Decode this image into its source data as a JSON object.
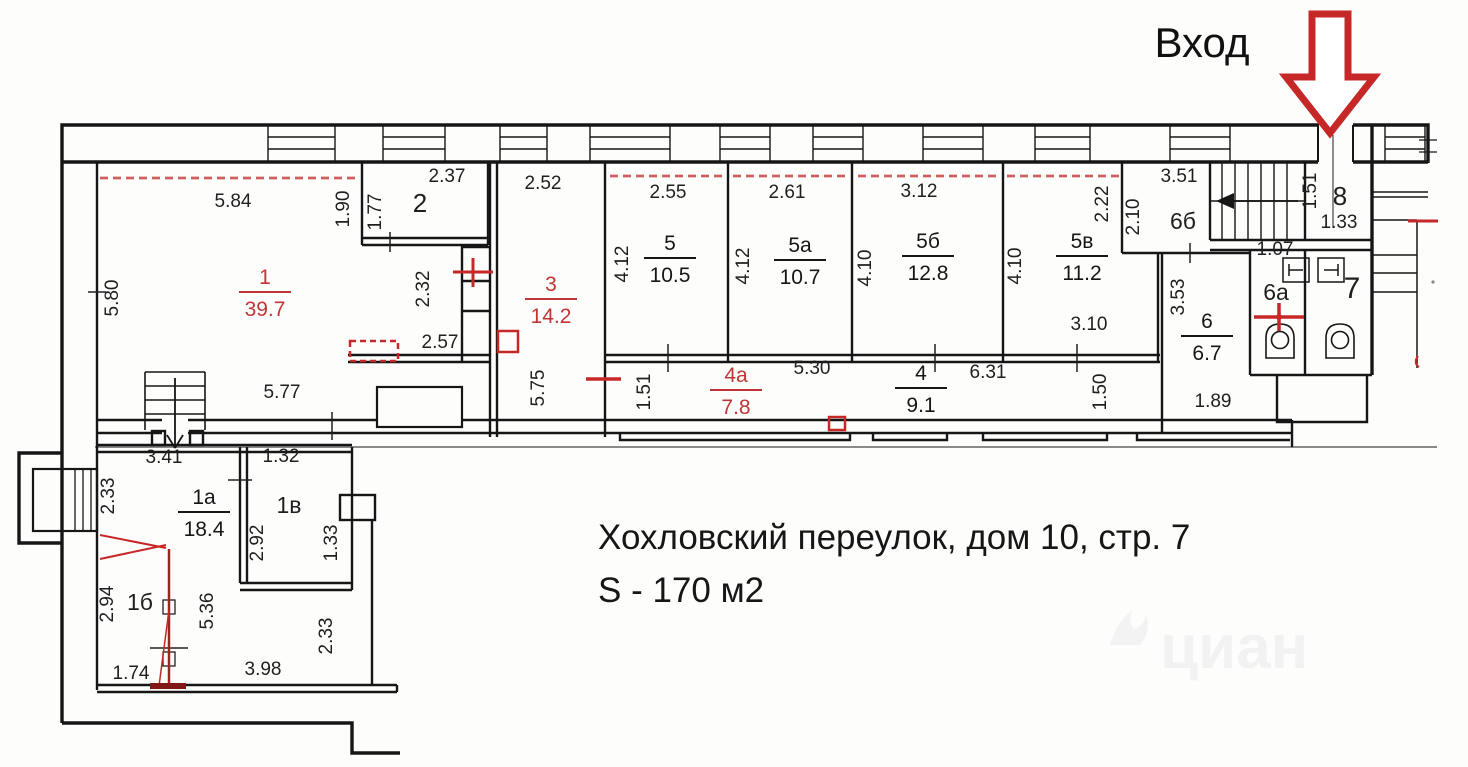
{
  "texts": {
    "address": "Хохловский переулок, дом 10, стр. 7",
    "area": "S - 170 м2",
    "entrance": "Вход",
    "watermark": "циан"
  },
  "colors": {
    "wall": "#161616",
    "red": "#c62828",
    "red_dark": "#8f1d1d",
    "red_label": "#c03535",
    "dashed_red": "#d06060",
    "gray_line": "#7a7a7a",
    "text": "#1f1f1f"
  },
  "room_labels": [
    {
      "num": "1",
      "area": "39.7",
      "x": 265,
      "y": 292,
      "red": true
    },
    {
      "num": "3",
      "area": "14.2",
      "x": 551,
      "y": 299,
      "red": true
    },
    {
      "num": "5",
      "area": "10.5",
      "x": 670,
      "y": 258,
      "red": false
    },
    {
      "num": "5а",
      "area": "10.7",
      "x": 800,
      "y": 260,
      "red": false
    },
    {
      "num": "5б",
      "area": "12.8",
      "x": 928,
      "y": 256,
      "red": false
    },
    {
      "num": "5в",
      "area": "11.2",
      "x": 1082,
      "y": 256,
      "red": false
    },
    {
      "num": "4а",
      "area": "7.8",
      "x": 736,
      "y": 390,
      "red": true
    },
    {
      "num": "4",
      "area": "9.1",
      "x": 921,
      "y": 388,
      "red": false
    },
    {
      "num": "6",
      "area": "6.7",
      "x": 1207,
      "y": 336,
      "red": false
    },
    {
      "num": "1а",
      "area": "18.4",
      "x": 204,
      "y": 512,
      "red": false
    }
  ],
  "simple_labels": [
    {
      "t": "2",
      "x": 420,
      "y": 212,
      "s": 26
    },
    {
      "t": "6б",
      "x": 1183,
      "y": 229,
      "s": 23
    },
    {
      "t": "8",
      "x": 1340,
      "y": 205,
      "s": 26
    },
    {
      "t": "6а",
      "x": 1276,
      "y": 300,
      "s": 23
    },
    {
      "t": "7",
      "x": 1352,
      "y": 298,
      "s": 30
    },
    {
      "t": "1в",
      "x": 289,
      "y": 513,
      "s": 23
    },
    {
      "t": "1б",
      "x": 140,
      "y": 610,
      "s": 23
    }
  ],
  "dimensions": [
    {
      "t": "5.84",
      "x": 233,
      "y": 207,
      "rot": false
    },
    {
      "t": "2.37",
      "x": 447,
      "y": 182,
      "rot": false
    },
    {
      "t": "2.52",
      "x": 543,
      "y": 189,
      "rot": false
    },
    {
      "t": "2.55",
      "x": 668,
      "y": 198,
      "rot": false
    },
    {
      "t": "2.61",
      "x": 787,
      "y": 198,
      "rot": false
    },
    {
      "t": "3.12",
      "x": 919,
      "y": 197,
      "rot": false
    },
    {
      "t": "3.51",
      "x": 1179,
      "y": 182,
      "rot": false
    },
    {
      "t": "2.57",
      "x": 440,
      "y": 348,
      "rot": false
    },
    {
      "t": "5.77",
      "x": 282,
      "y": 398,
      "rot": false
    },
    {
      "t": "5.30",
      "x": 812,
      "y": 374,
      "rot": false
    },
    {
      "t": "6.31",
      "x": 988,
      "y": 378,
      "rot": false
    },
    {
      "t": "3.10",
      "x": 1089,
      "y": 330,
      "rot": false
    },
    {
      "t": "1.33",
      "x": 1339,
      "y": 228,
      "rot": false
    },
    {
      "t": "1.07",
      "x": 1275,
      "y": 255,
      "rot": false
    },
    {
      "t": "1.89",
      "x": 1213,
      "y": 407,
      "rot": false
    },
    {
      "t": "3.41",
      "x": 164,
      "y": 463,
      "rot": false
    },
    {
      "t": "1.32",
      "x": 281,
      "y": 462,
      "rot": false
    },
    {
      "t": "1.74",
      "x": 131,
      "y": 679,
      "rot": false
    },
    {
      "t": "3.98",
      "x": 263,
      "y": 675,
      "rot": false
    },
    {
      "t": "5.80",
      "x": 118,
      "y": 298,
      "rot": true
    },
    {
      "t": "1.90",
      "x": 349,
      "y": 209,
      "rot": true
    },
    {
      "t": "1.77",
      "x": 381,
      "y": 212,
      "rot": true
    },
    {
      "t": "2.32",
      "x": 429,
      "y": 289,
      "rot": true
    },
    {
      "t": "5.75",
      "x": 544,
      "y": 388,
      "rot": true
    },
    {
      "t": "4.12",
      "x": 628,
      "y": 264,
      "rot": true
    },
    {
      "t": "4.12",
      "x": 749,
      "y": 266,
      "rot": true
    },
    {
      "t": "4.10",
      "x": 871,
      "y": 268,
      "rot": true
    },
    {
      "t": "4.10",
      "x": 1021,
      "y": 266,
      "rot": true
    },
    {
      "t": "2.22",
      "x": 1108,
      "y": 204,
      "rot": true
    },
    {
      "t": "2.10",
      "x": 1139,
      "y": 217,
      "rot": true
    },
    {
      "t": "1.51",
      "x": 1316,
      "y": 191,
      "rot": true
    },
    {
      "t": "1.51",
      "x": 650,
      "y": 392,
      "rot": true
    },
    {
      "t": "1.50",
      "x": 1106,
      "y": 392,
      "rot": true
    },
    {
      "t": "3.53",
      "x": 1184,
      "y": 297,
      "rot": true
    },
    {
      "t": "2.33",
      "x": 114,
      "y": 496,
      "rot": true
    },
    {
      "t": "2.94",
      "x": 113,
      "y": 604,
      "rot": true
    },
    {
      "t": "2.92",
      "x": 263,
      "y": 543,
      "rot": true
    },
    {
      "t": "1.33",
      "x": 337,
      "y": 543,
      "rot": true
    },
    {
      "t": "2.33",
      "x": 332,
      "y": 636,
      "rot": true
    },
    {
      "t": "5.36",
      "x": 213,
      "y": 611,
      "rot": true
    }
  ]
}
